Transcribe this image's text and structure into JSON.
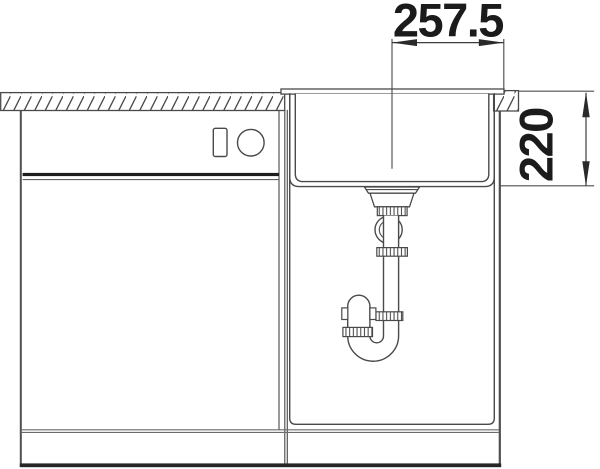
{
  "dimensions": {
    "bowl_center_to_right_edge": "257.5",
    "bowl_depth": "220"
  },
  "colors": {
    "background": "#ffffff",
    "line": "#4a4a4a",
    "thick_line": "#1e1e1e",
    "dimension_text": "#1b1b1b"
  }
}
